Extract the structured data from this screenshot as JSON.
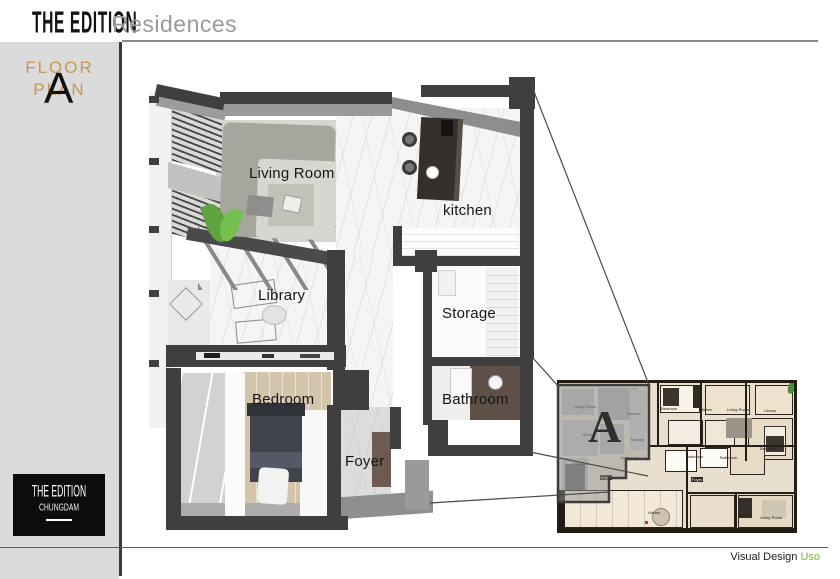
{
  "header": {
    "brand": "THE EDITION",
    "subtitle": "Residences"
  },
  "sidebar": {
    "floor": "FLOOR",
    "plan": "PLAN",
    "letter": "A",
    "logo_line1": "THE EDITION",
    "logo_line2": "CHUNGDAM"
  },
  "plan": {
    "labels": {
      "living_room": "Living Room",
      "kitchen": "kitchen",
      "library": "Library",
      "storage": "Storage",
      "bedroom": "Bedroom",
      "bathroom": "Bathroom",
      "foyer": "Foyer"
    }
  },
  "inset": {
    "unit_letter": "A",
    "labels": [
      {
        "text": "Living Room"
      },
      {
        "text": "Kitchen"
      },
      {
        "text": "Library"
      },
      {
        "text": "Storage"
      },
      {
        "text": "Bathroom"
      },
      {
        "text": "Bedroom"
      },
      {
        "text": "Foyer"
      },
      {
        "text": "Bedroom"
      },
      {
        "text": "Kitchen"
      },
      {
        "text": "Living Room"
      },
      {
        "text": "Library"
      },
      {
        "text": "Bathroom"
      },
      {
        "text": "Bathroom"
      },
      {
        "text": "Bedroom"
      },
      {
        "text": "Foyer"
      },
      {
        "text": "Library"
      },
      {
        "text": "Kitchen"
      },
      {
        "text": "Living Room"
      }
    ]
  },
  "footer": {
    "credit_label": "Visual Design",
    "credit_name": "Uso"
  },
  "colors": {
    "gold": "#C49A50",
    "green": "#7CB43E",
    "wall": "#3F3F3F"
  }
}
